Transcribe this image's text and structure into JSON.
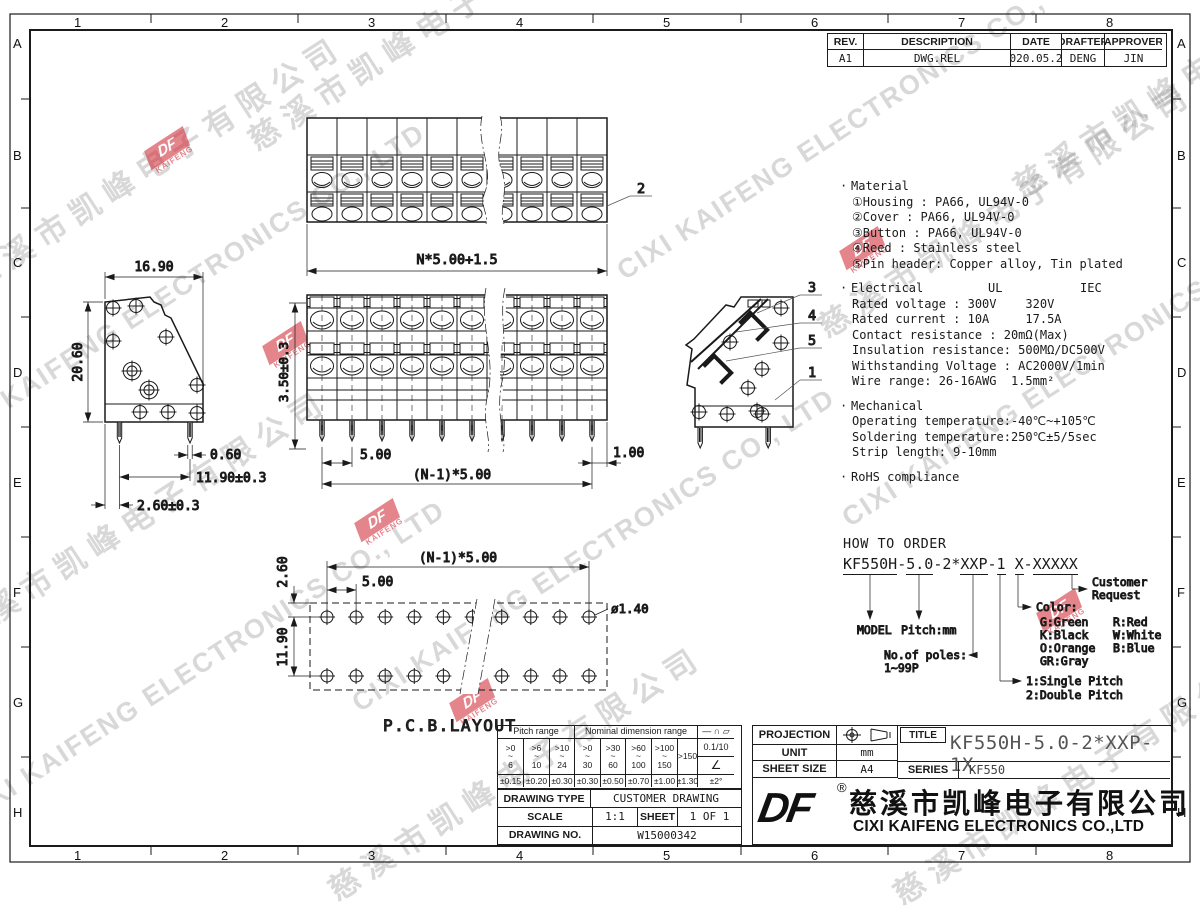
{
  "sheet": {
    "cols": [
      "1",
      "2",
      "3",
      "4",
      "5",
      "6",
      "7",
      "8"
    ],
    "rows": [
      "A",
      "B",
      "C",
      "D",
      "E",
      "F",
      "G",
      "H"
    ]
  },
  "rev": {
    "headers": [
      "REV.",
      "DESCRIPTION",
      "DATE",
      "DRAFTER",
      "APPROVER"
    ],
    "row": [
      "A1",
      "DWG.REL",
      "2020.05.28",
      "DENG",
      "JIN"
    ]
  },
  "specs": {
    "material": {
      "title": "Material",
      "items": [
        "①Housing : PA66, UL94V-0",
        "②Cover : PA66, UL94V-0",
        "③Button : PA66, UL94V-0",
        "④Reed : Stainless steel",
        "⑤Pin header: Copper alloy, Tin plated"
      ]
    },
    "electrical": {
      "title": "Electrical",
      "col1": "UL",
      "col2": "IEC",
      "items": [
        "Rated voltage : 300V    320V",
        "Rated current : 10A     17.5A",
        "Contact resistance : 20mΩ(Max)",
        "Insulation resistance: 500MΩ/DC500V",
        "Withstanding Voltage : AC2000V/1min",
        "Wire range: 26-16AWG  1.5mm²"
      ]
    },
    "mechanical": {
      "title": "Mechanical",
      "items": [
        "Operating temperature:-40℃~+105℃",
        "Soldering temperature:250℃±5/5sec",
        "Strip length: 9-10mm"
      ]
    },
    "rohs": "RoHS compliance"
  },
  "order": {
    "title": "HOW TO ORDER",
    "parts": [
      {
        "t": "KF550H"
      },
      {
        "t": "-"
      },
      {
        "t": "5.0"
      },
      {
        "t": "-2*"
      },
      {
        "t": "XXP"
      },
      {
        "t": "-"
      },
      {
        "t": "1"
      },
      {
        "t": " "
      },
      {
        "t": "X"
      },
      {
        "t": "-"
      },
      {
        "t": "XXXXX"
      }
    ],
    "model": "MODEL",
    "pitch": "Pitch:mm",
    "poles_label": "No.of poles:",
    "poles_range": "1~99P",
    "single": "1:Single Pitch",
    "double": "2:Double Pitch",
    "color_label": "Color:",
    "colors": [
      "G:Green",
      "R:Red",
      "K:Black",
      "W:White",
      "O:Orange",
      "B:Blue",
      "GR:Gray"
    ],
    "customer1": "Customer",
    "customer2": "Request"
  },
  "tol": {
    "pitch_label": "Pitch range",
    "nominal_label": "Nominal dimension range",
    "symbols": "— ∩ ▱",
    "pitch_ranges": [
      ">0\n~\n6",
      ">6\n~\n10",
      ">10\n~\n24"
    ],
    "nominal_ranges": [
      ">0\n~\n30",
      ">30\n~\n60",
      ">60\n~\n100",
      ">100\n~\n150",
      ">150"
    ],
    "straightness": "0.1/10",
    "angle_sym": "∠",
    "pitch_tols": [
      "±0.15",
      "±0.20",
      "±0.30"
    ],
    "nominal_tols": [
      "±0.30",
      "±0.50",
      "±0.70",
      "±1.00",
      "±1.30"
    ],
    "angle_tol": "±2°"
  },
  "info": {
    "type_label": "DRAWING TYPE",
    "type_value": "CUSTOMER DRAWING",
    "scale_label": "SCALE",
    "scale_value": "1:1",
    "sheet_label": "SHEET",
    "sheet_value": "1 OF 1",
    "no_label": "DRAWING NO.",
    "no_value": "W15000342"
  },
  "tb": {
    "projection_label": "PROJECTION",
    "unit_label": "UNIT",
    "unit": "mm",
    "sheet_size_label": "SHEET SIZE",
    "sheet_size": "A4",
    "title_label": "TITLE",
    "title": "KF550H-5.0-2*XXP-1X",
    "series_label": "SERIES",
    "series": "KF550",
    "logo": "DF",
    "reg": "®",
    "company_cn": "慈溪市凯峰电子有限公司",
    "company_en": "CIXI KAIFENG ELECTRONICS CO.,LTD"
  },
  "dims": {
    "side_w": "16.90",
    "side_h": "20.60",
    "pin_w": "0.60",
    "pin_span": "11.90±0.3",
    "pin_off": "2.60±0.3",
    "plan_w": "N*5.00+1.5",
    "front_h": "3.50±0.3",
    "front_pitch": "5.00",
    "front_span": "(N-1)*5.00",
    "front_end": "1.00",
    "pcb_top": "2.60",
    "pcb_pitch": "5.00",
    "pcb_span": "(N-1)*5.00",
    "pcb_rows": "11.90",
    "pcb_hole": "ø1.40",
    "pcb_label": "P.C.B.LAYOUT"
  },
  "callouts": {
    "c1": "1",
    "c2": "2",
    "c3": "3",
    "c4": "4",
    "c5": "5"
  },
  "wm": {
    "en": "CIXI KAIFENG ELECTRONICS CO., LTD",
    "cn": "慈溪市凯峰电子有限公司",
    "logo": "DF",
    "logo_sub": "KAIFENG"
  }
}
